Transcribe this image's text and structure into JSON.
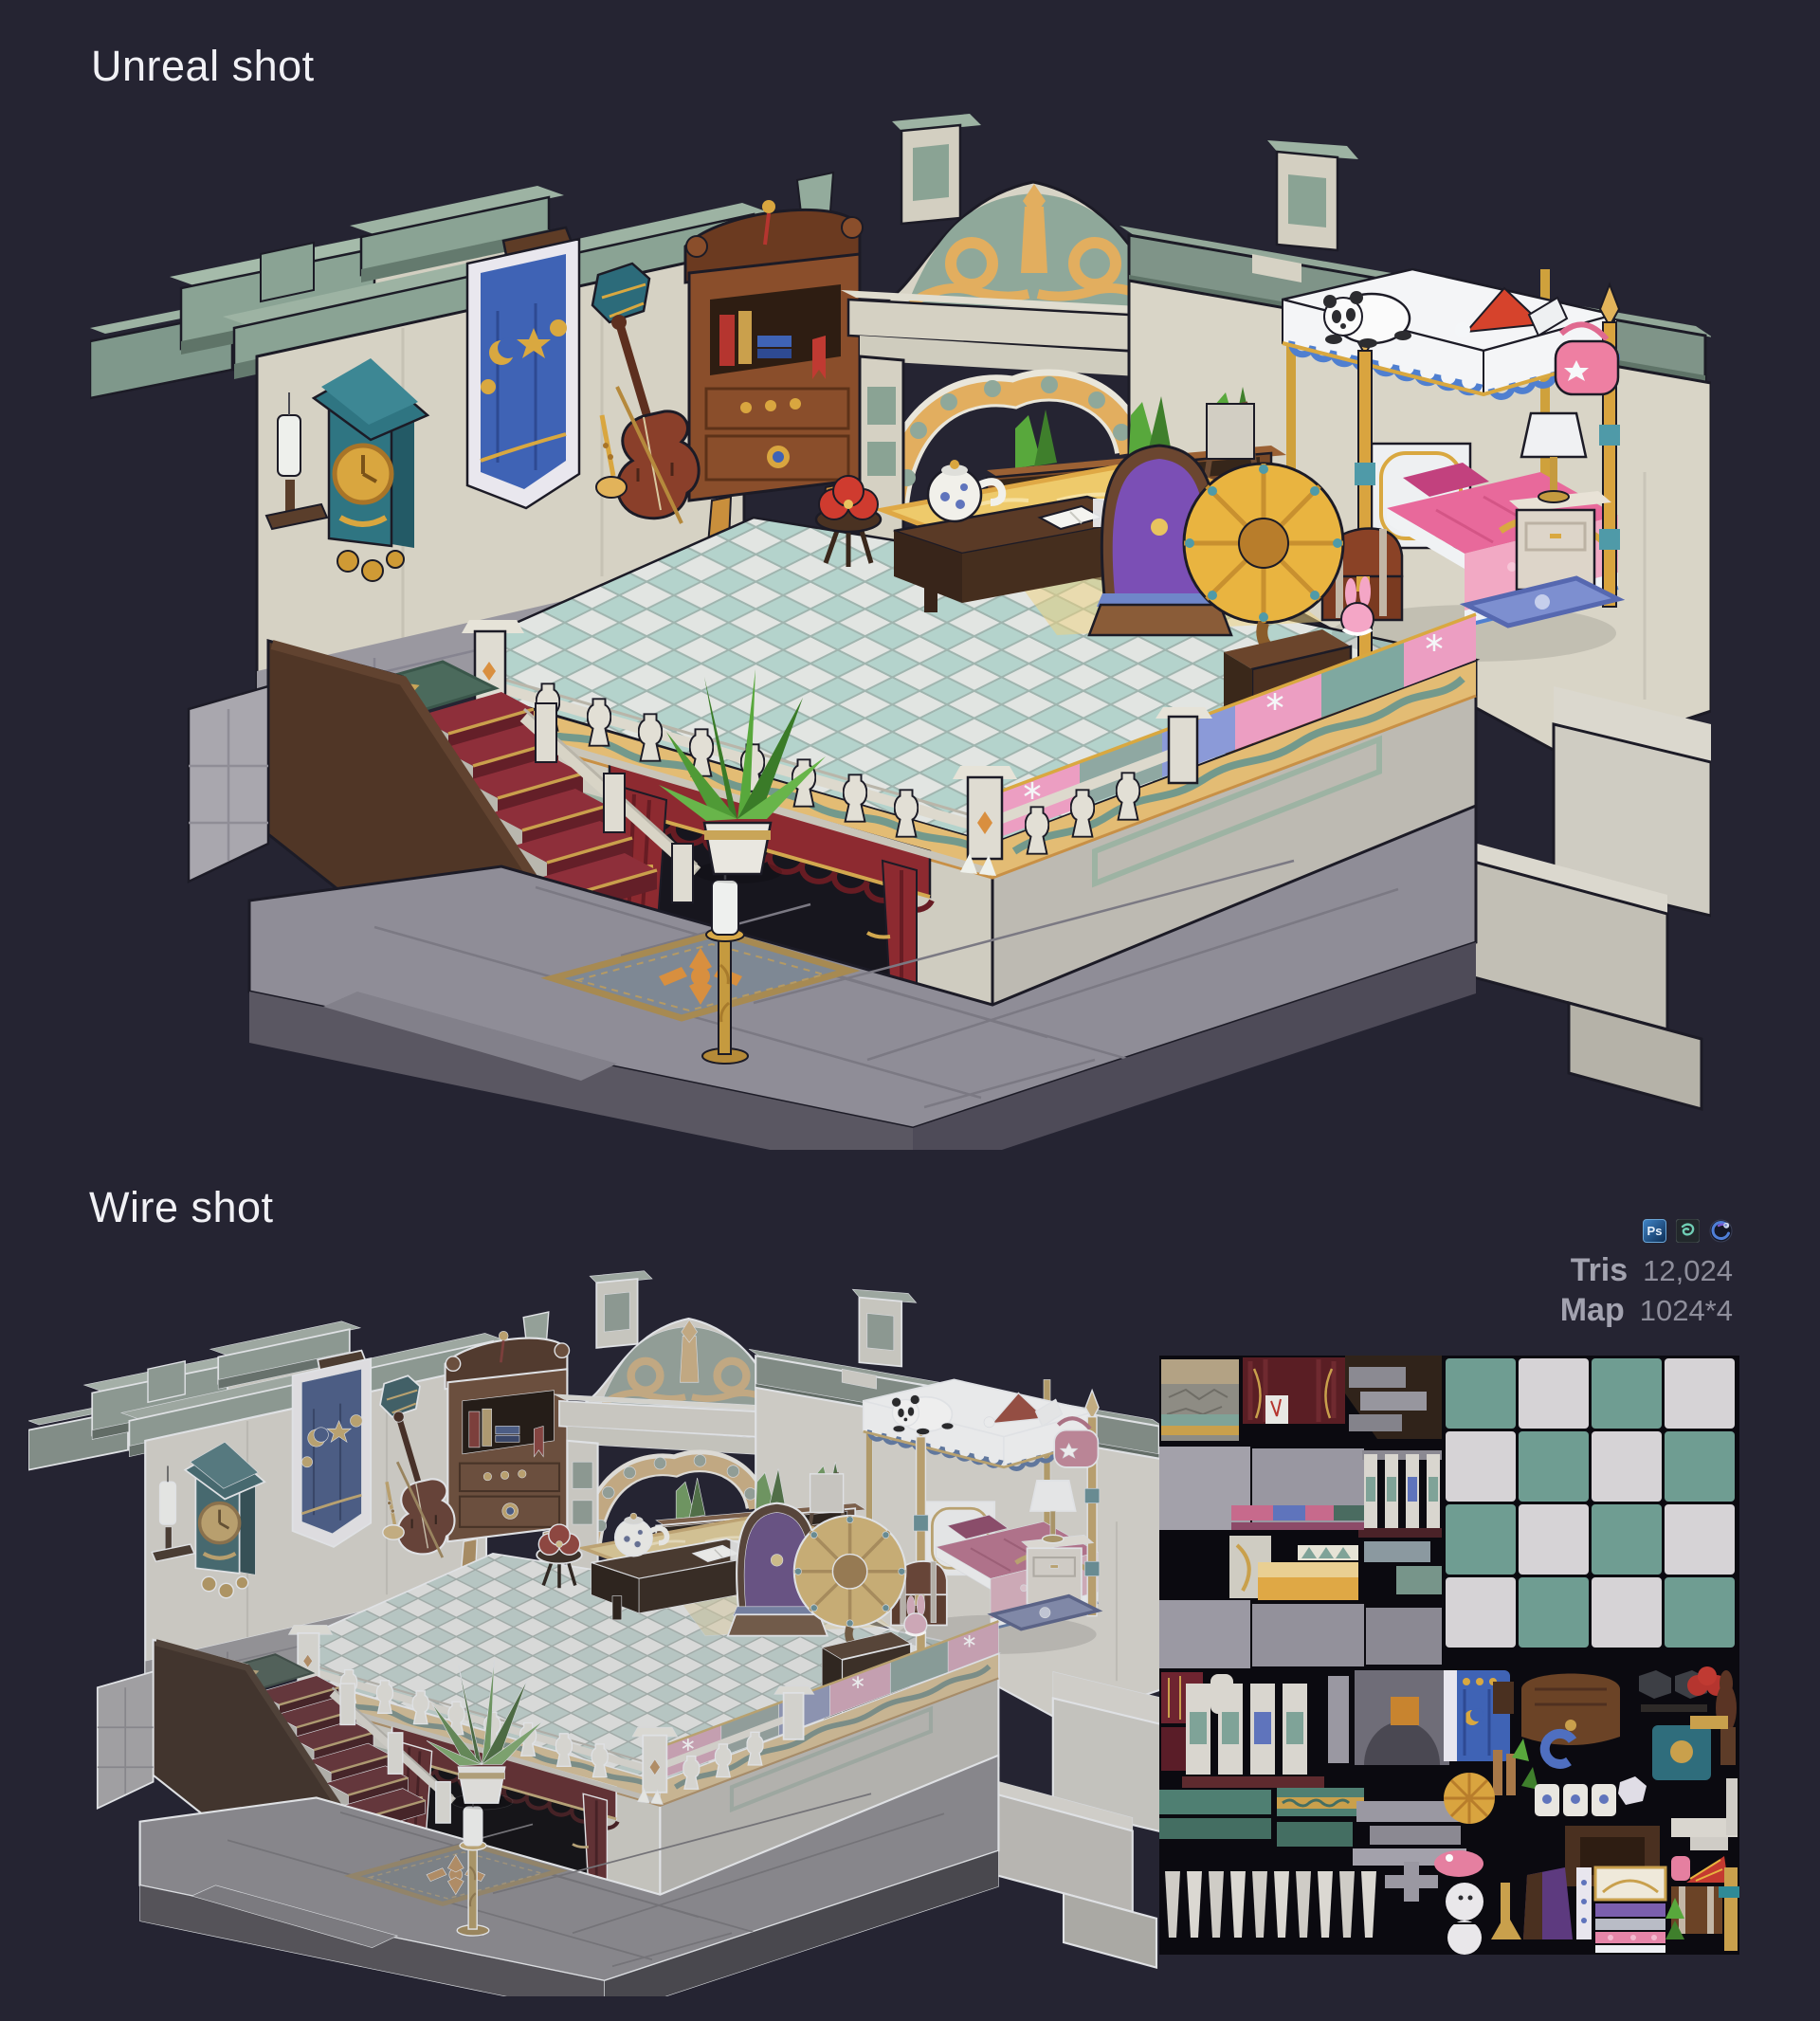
{
  "sections": {
    "unreal": {
      "label": "Unreal shot"
    },
    "wire": {
      "label": "Wire shot"
    }
  },
  "stats": {
    "tris_label": "Tris",
    "tris_value": "12,024",
    "map_label": "Map",
    "map_value": "1024*4"
  },
  "software_icons": [
    {
      "name": "photoshop",
      "abbr": "Ps"
    },
    {
      "name": "3ds-max"
    },
    {
      "name": "cinema-4d"
    }
  ],
  "palette": {
    "background": "#252432",
    "heading_text": "#f1f1f5",
    "stat_label": "#a2a2af",
    "stat_value": "#8e8e9b",
    "wall_cream": "#d6d2c4",
    "cornice_sage": "#8aa394",
    "ornament_gold": "#e2ae5f",
    "wood_brown": "#8a4e2b",
    "carpet_red": "#8e2f3a",
    "curtain_red": "#8d2a30",
    "banner_blue": "#3f63b5",
    "tile_teal": "#b4d3cc",
    "tile_white": "#e2e5e2",
    "bed_pink": "#e8699b",
    "runner_pink": "#ec9ec2",
    "horn_gold": "#e9b440",
    "atlas_bg": "#0b0a10",
    "atlas_tile_teal": "#6f9d92",
    "atlas_tile_white": "#d6d3d6"
  }
}
